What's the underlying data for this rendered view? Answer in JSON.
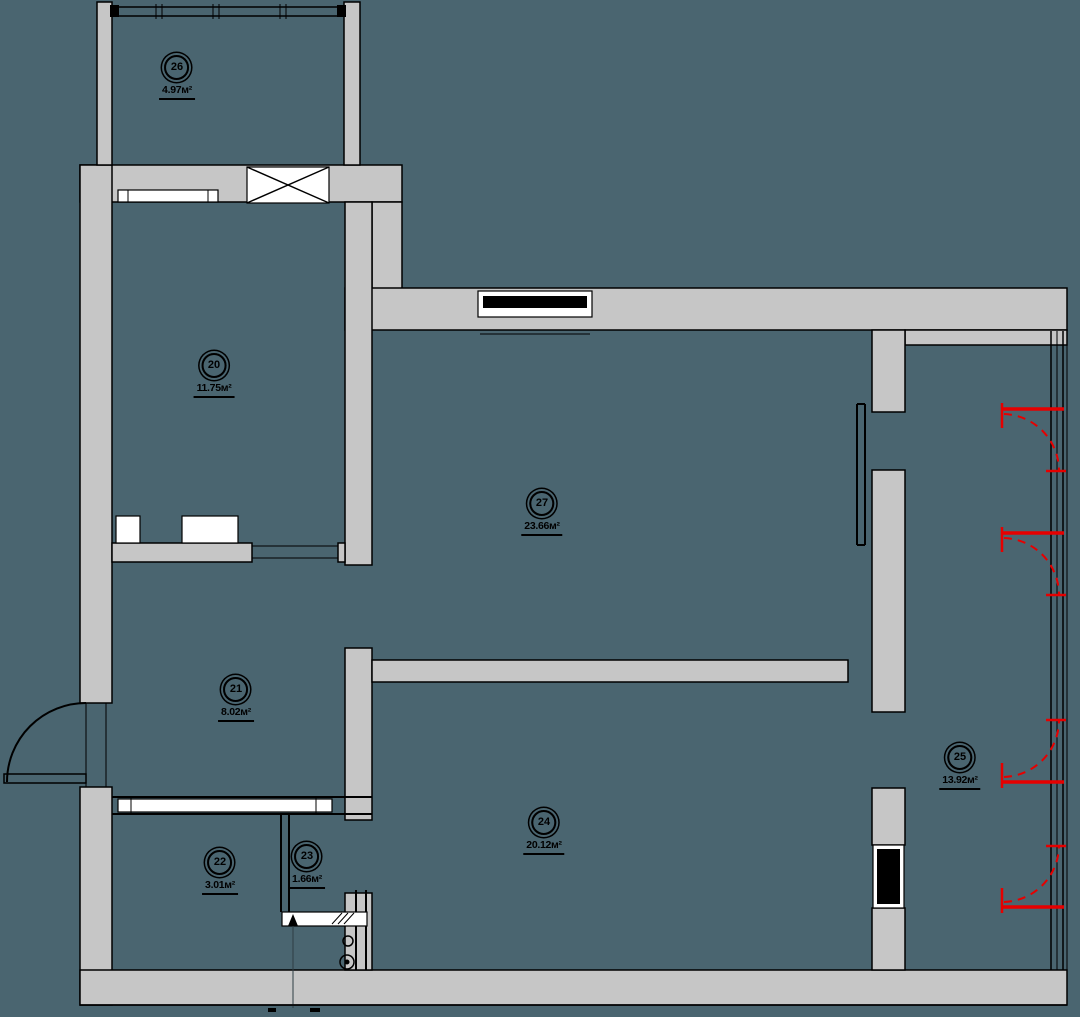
{
  "document": {
    "type": "apartment-floor-plan",
    "units": "м²"
  },
  "colors": {
    "background": "#4a6570",
    "wall_fill": "#c6c6c6",
    "line": "#000000",
    "red": "#e60000",
    "opening": "#ffffff"
  },
  "rooms": [
    {
      "number": "26",
      "area": "4.97м²"
    },
    {
      "number": "20",
      "area": "11.75м²"
    },
    {
      "number": "27",
      "area": "23.66м²"
    },
    {
      "number": "21",
      "area": "8.02м²"
    },
    {
      "number": "22",
      "area": "3.01м²"
    },
    {
      "number": "23",
      "area": "1.66м²"
    },
    {
      "number": "24",
      "area": "20.12м²"
    },
    {
      "number": "25",
      "area": "13.92м²"
    }
  ]
}
